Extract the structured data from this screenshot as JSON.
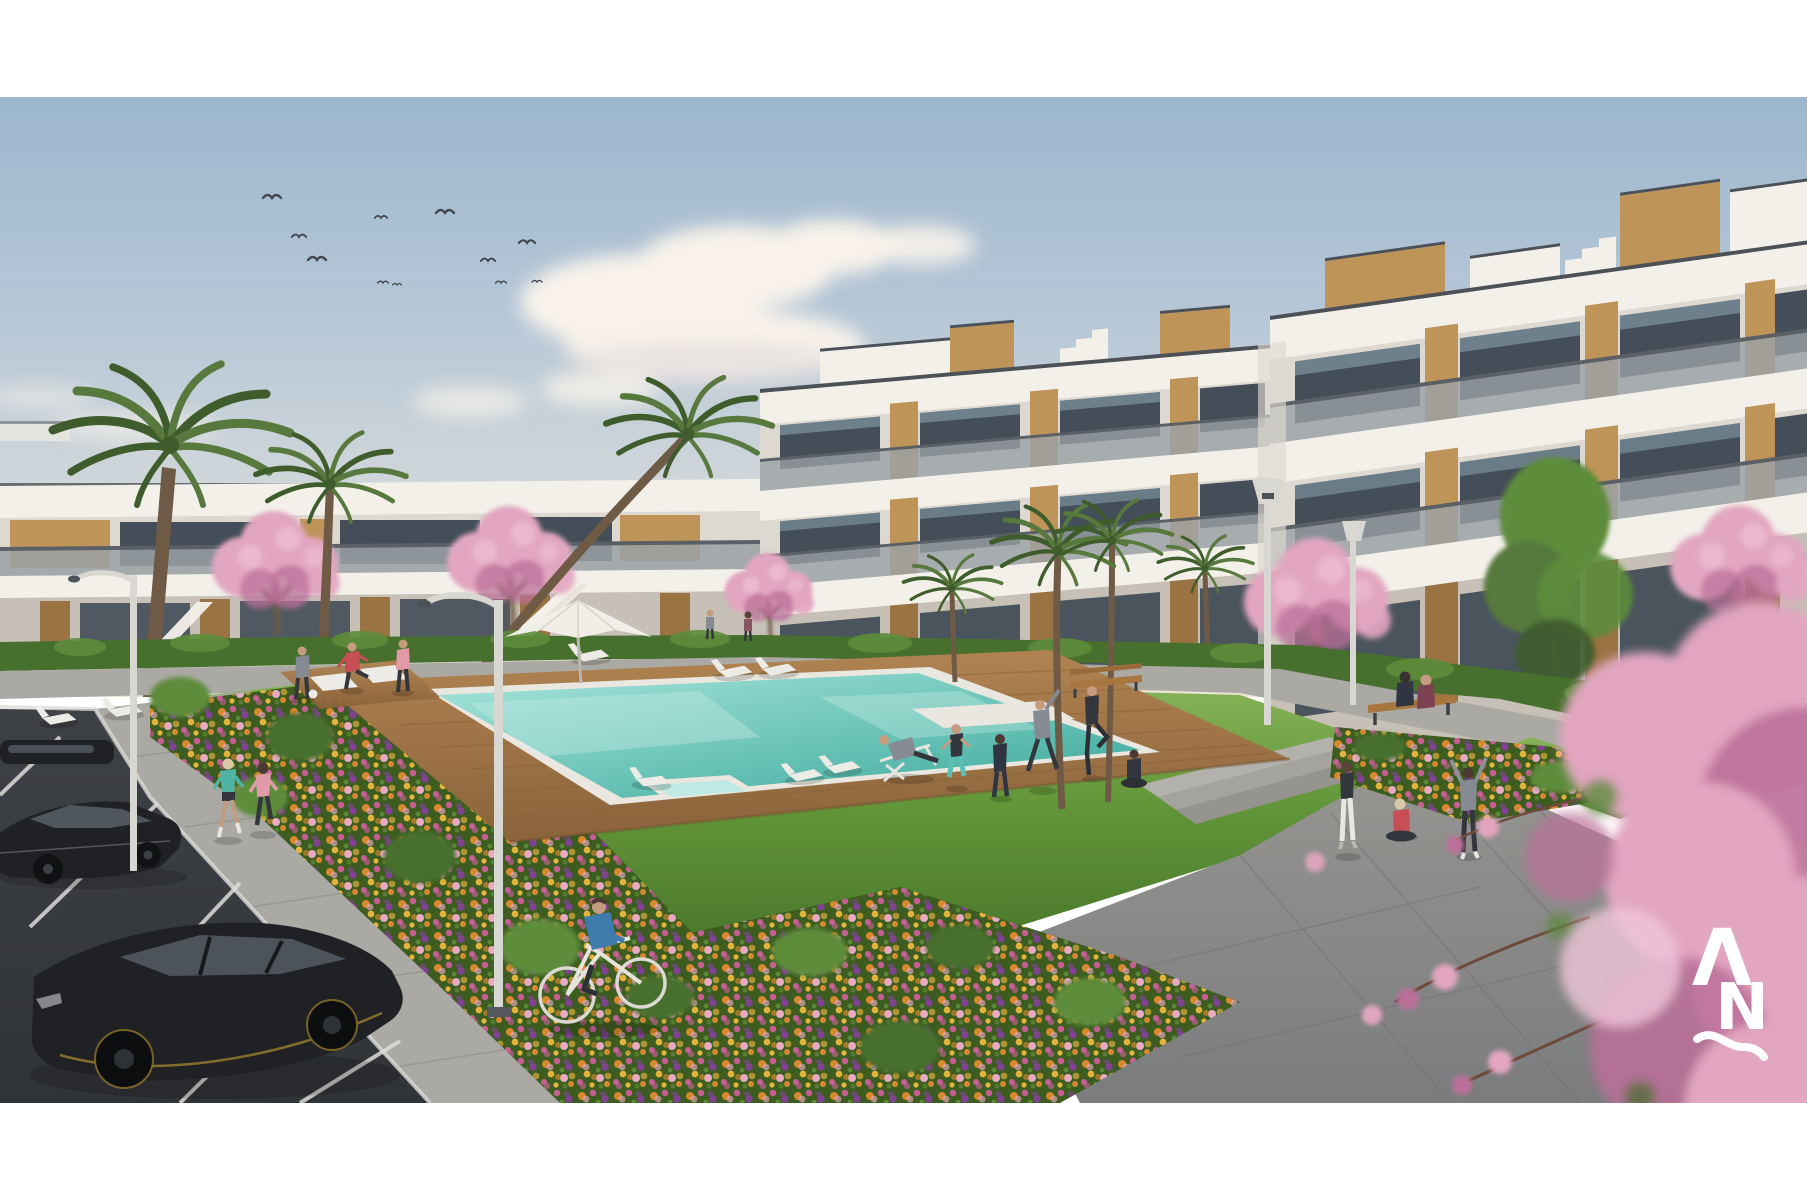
{
  "meta": {
    "type": "architectural-rendering",
    "subject": "modern residential apartment complex with communal pool and gardens",
    "setting": "sunny day, landscaped courtyard, parking lot in foreground",
    "frame": "white border above and below the rendering"
  },
  "palette": {
    "paper": "#ffffff",
    "skyTop": "#9cb6ce",
    "skyMid": "#b7c8d7",
    "skyLow": "#d3d8da",
    "horizon": "#ece4d4",
    "cloud": "#f8f2ea",
    "cloudShadow": "#d9d3d6",
    "buildingWhite": "#f3f0ea",
    "buildingShade": "#ddd8d0",
    "buildingShadow": "#c6c0b6",
    "roofEdge": "#4c5158",
    "wood": "#bf9459",
    "woodDark": "#9a7342",
    "glassDark": "#434e58",
    "glassSky": "#93a9b9",
    "railGray": "#9aa1a6",
    "railEdge": "#5a6065",
    "grassLight": "#8ab55a",
    "grass": "#63973a",
    "grassDark": "#48762a",
    "hedge": "#47702e",
    "hedgeLight": "#5d8c3b",
    "bedBase": "#3c5c20",
    "flowerOrange": "#d8882e",
    "flowerMagenta": "#c75f95",
    "flowerPurple": "#7e4290",
    "flowerGold": "#e3b33c",
    "flowerPink": "#e6aac4",
    "pathLight": "#aaa9a4",
    "pathMid": "#979692",
    "pathDark": "#7b7c7e",
    "curb": "#d6d5d1",
    "asphalt": "#3e4146",
    "asphaltDark": "#303337",
    "lineWhite": "#dcdcd8",
    "deckWood": "#b08351",
    "deckWoodDark": "#8a633b",
    "coping": "#eae7e0",
    "poolLight": "#a6e4db",
    "poolDeep": "#3aa89a",
    "blossom": "#e2a6c0",
    "blossomDark": "#bb6f99",
    "blossomLight": "#f0c6d8",
    "trunk": "#6f5b45",
    "palmGreen": "#57793d",
    "palmDark": "#3f5c2c",
    "skin": "#c59c7f",
    "lounger": "#edebe5",
    "teal": "#4fb4a4",
    "pinkTop": "#e29aa8",
    "redTop": "#c64f55",
    "navy": "#2f3542",
    "grayOutfit": "#868a92",
    "darkOutfit": "#33373d",
    "blueShirt": "#3e7cae",
    "whitePants": "#e9e7e3",
    "carDark": "#1f2125",
    "carWindow": "#555c64",
    "carTrim": "#a98d2f",
    "birdDark": "#424750",
    "lampPole": "#d9d7d2",
    "logoWhite": "#ffffff"
  },
  "logo": {
    "letter_a": "Λ",
    "letter_n": "N",
    "mark": "wave-underline",
    "color": "#ffffff"
  },
  "scene": {
    "sky": {
      "condition": "clear with cumulus clouds",
      "birds_count": 11
    },
    "buildings": {
      "right_block": "3-storey white apartment wings with glass balconies, timber panel accents and rooftop penthouse boxes",
      "left_block": "2-storey white apartment row with timber panels and external staircases"
    },
    "amenities": [
      "swimming pool with wooden deck",
      "jacuzzi corner",
      "sun loungers",
      "white parasol",
      "benches",
      "yoga platform",
      "flower beds",
      "lawn",
      "palm trees",
      "cherry blossom trees",
      "street lamps",
      "parking lot"
    ],
    "people": [
      "two women jogging",
      "man cycling",
      "woman jogging in red top",
      "man holding ball",
      "man kicking ball",
      "woman in pink top",
      "man relaxing on deck chair",
      "woman squatting",
      "person in tracksuit",
      "man side-stretching",
      "man quad-stretching",
      "woman sitting cross-legged",
      "woman standing",
      "woman sitting on pavement",
      "person stretching arms up",
      "couple sitting on bench",
      "two residents on far walkway"
    ],
    "vehicles": [
      "black hatchback",
      "dark sedan",
      "partially visible parked car",
      "bicycle"
    ]
  }
}
